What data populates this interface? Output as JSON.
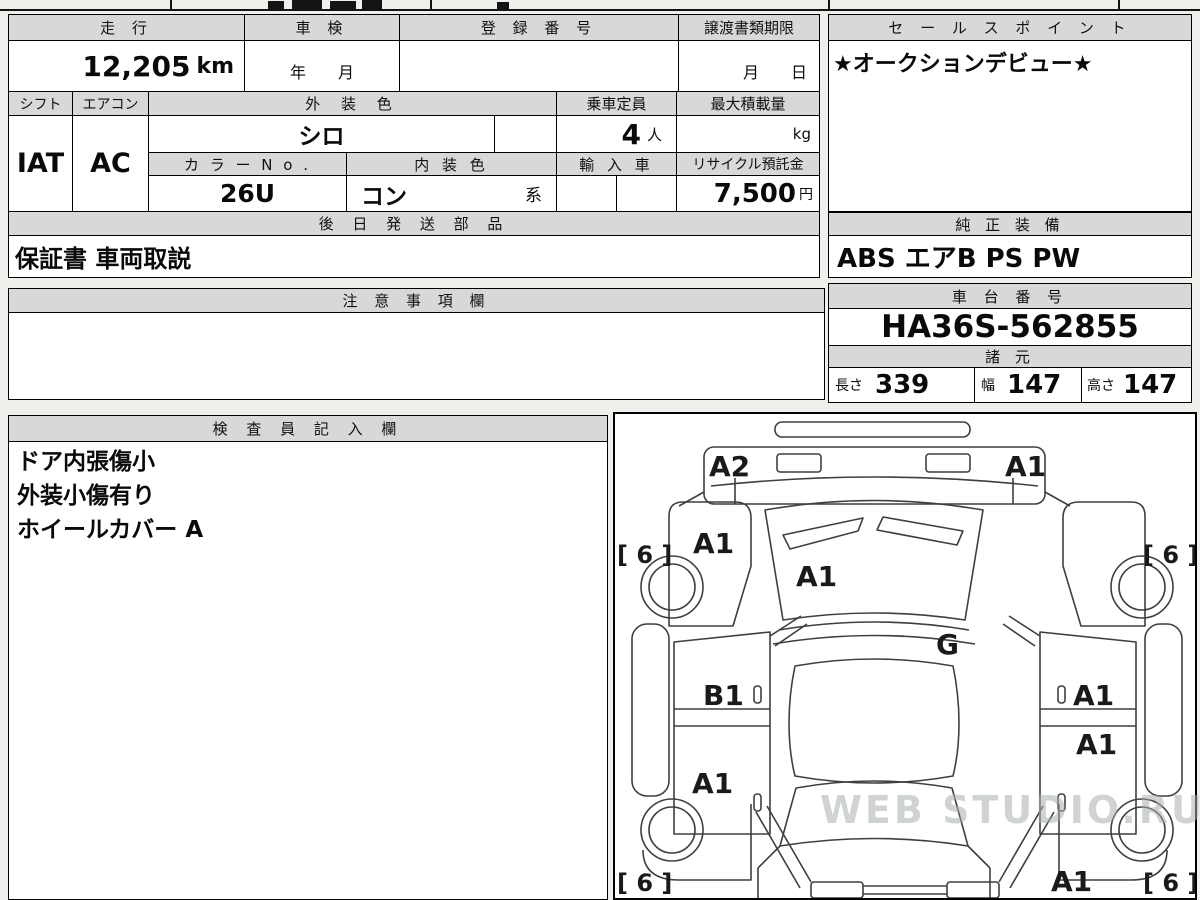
{
  "watermark": "WEB STUDIO.RU",
  "info": {
    "mileage": {
      "label": "走 行",
      "value": "12,205",
      "unit": "km"
    },
    "inspection": {
      "label": "車 検",
      "value": "年　　月"
    },
    "registration": {
      "label": "登 録 番 号",
      "value": ""
    },
    "transfer_docs": {
      "label": "譲渡書類期限",
      "value": "月　　日"
    },
    "shift": {
      "label": "シフト",
      "value": "IAT"
    },
    "aircon": {
      "label": "エアコン",
      "value": "AC"
    },
    "exterior_color": {
      "label": "外 装 色",
      "value": "シロ"
    },
    "capacity": {
      "label": "乗車定員",
      "value": "4",
      "unit": "人"
    },
    "max_load": {
      "label": "最大積載量",
      "value": "",
      "unit": "kg"
    },
    "color_no": {
      "label": "カ ラ ー N o .",
      "value": "26U"
    },
    "interior_color": {
      "label": "内 装 色",
      "value": "コン",
      "suffix": "系"
    },
    "import_car": {
      "label": "輸 入 車",
      "value": ""
    },
    "recycle_deposit": {
      "label": "リサイクル預託金",
      "value": "7,500",
      "unit": "円"
    },
    "later_parts": {
      "label": "後 日 発 送 部 品",
      "value": "保証書 車両取説"
    },
    "sales_point": {
      "label": "セ ー ル ス ポ イ ン ト",
      "value": "★オークションデビュー★"
    },
    "equipment": {
      "label": "純 正 装 備",
      "value": "ABS エアB PS PW"
    },
    "notes": {
      "label": "注 意 事 項 欄",
      "value": ""
    },
    "chassis_no": {
      "label": "車 台 番 号",
      "value": "HA36S-562855"
    },
    "specs": {
      "label": "諸 元",
      "length": {
        "label": "長さ",
        "value": "339"
      },
      "width": {
        "label": "幅",
        "value": "147"
      },
      "height": {
        "label": "高さ",
        "value": "147"
      }
    },
    "inspector": {
      "label": "検 査 員 記 入 欄",
      "lines": [
        "ドア内張傷小",
        "外装小傷有り",
        "ホイールカバー A"
      ]
    }
  },
  "diagram": {
    "front_bumper_left": "A2",
    "front_bumper_right": "A1",
    "left_fender": "A1",
    "windshield": "A1",
    "cowl": "G",
    "left_front_door": "B1",
    "left_rear_door": "A1",
    "right_front_door": "A1",
    "right_rear_door": "A1",
    "right_rear_quarter": "A1",
    "tire_front_left": "[ 6 ]",
    "tire_front_right": "[ 6 ]",
    "tire_rear_left": "[ 6 ]",
    "tire_rear_right": "[ 6 ]"
  }
}
